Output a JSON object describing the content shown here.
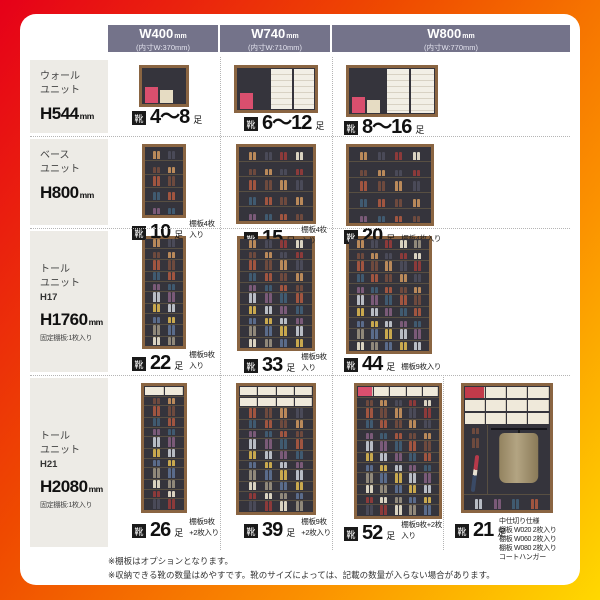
{
  "shoe_icon_glyph": "靴",
  "capacity_counter": "足",
  "colors": {
    "gradient": [
      "#e60019",
      "#ef4a00",
      "#ffd800"
    ],
    "header_bg": "#74738a",
    "row_label_bg": "#edebe6",
    "frame_wood": "#8a6542",
    "interior": "#35343c",
    "accent_box": "#d94f6e"
  },
  "header": {
    "columns": [
      {
        "title": "W400",
        "unit": "mm",
        "inner": "(内寸W:370mm)"
      },
      {
        "title": "W740",
        "unit": "mm",
        "inner": "(内寸W:710mm)"
      },
      {
        "title": "W800",
        "unit": "mm",
        "inner": "(内寸W:770mm)"
      }
    ]
  },
  "rows": [
    {
      "unit_lines": [
        "ウォール",
        "ユニット"
      ],
      "height": "H544",
      "height_unit": "mm",
      "cells": [
        {
          "count": "4〜8",
          "cabinet": {
            "kind": "wall",
            "w": 50,
            "h": 42,
            "boxes": [
              "#d94f6e",
              "#e6dcc3"
            ],
            "doors": 0
          }
        },
        {
          "count": "6〜12",
          "cabinet": {
            "kind": "wall",
            "w": 84,
            "h": 48,
            "boxes": [
              "#d94f6e"
            ],
            "doors": 2
          }
        },
        {
          "count": "8〜16",
          "cabinet": {
            "kind": "wall",
            "w": 92,
            "h": 52,
            "boxes": [
              "#d94f6e",
              "#e6dcc3"
            ],
            "doors": 2
          }
        }
      ]
    },
    {
      "unit_lines": [
        "ベース",
        "ユニット"
      ],
      "height": "H800",
      "height_unit": "mm",
      "cells": [
        {
          "count": "10",
          "note": "棚板4枚入り",
          "cabinet": {
            "kind": "shoes",
            "w": 44,
            "h": 74,
            "rows": 5,
            "cols": 2
          }
        },
        {
          "count": "15",
          "note": "棚板4枚入り",
          "cabinet": {
            "kind": "shoes",
            "w": 80,
            "h": 80,
            "rows": 5,
            "cols": 4
          }
        },
        {
          "count": "20",
          "note": "棚板4枚入り",
          "cabinet": {
            "kind": "shoes",
            "w": 88,
            "h": 82,
            "rows": 5,
            "cols": 4
          }
        }
      ]
    },
    {
      "unit_lines": [
        "トール",
        "ユニット"
      ],
      "code": "H17",
      "height": "H1760",
      "height_unit": "mm",
      "unit_note": "固定棚板:1枚入り",
      "cells": [
        {
          "count": "22",
          "note": "棚板9枚入り",
          "cabinet": {
            "kind": "shoes",
            "w": 44,
            "h": 113,
            "rows": 10,
            "cols": 2
          }
        },
        {
          "count": "33",
          "note": "棚板9枚入り",
          "cabinet": {
            "kind": "shoes",
            "w": 78,
            "h": 115,
            "rows": 10,
            "cols": 4
          }
        },
        {
          "count": "44",
          "note": "棚板9枚入り",
          "cabinet": {
            "kind": "shoes",
            "w": 86,
            "h": 118,
            "rows": 10,
            "cols": 5
          }
        }
      ]
    },
    {
      "unit_lines": [
        "トール",
        "ユニット"
      ],
      "code": "H21",
      "height": "H2080",
      "height_unit": "mm",
      "unit_note": "固定棚板:1枚入り",
      "cells": [
        {
          "count": "26",
          "note": "棚板9枚+2枚入り",
          "cabinet": {
            "kind": "shoes",
            "w": 46,
            "h": 130,
            "rows": 12,
            "cols": 2,
            "boxRows": 1
          }
        },
        {
          "count": "39",
          "note": "棚板9枚+2枚入り",
          "cabinet": {
            "kind": "shoes",
            "w": 80,
            "h": 132,
            "rows": 12,
            "cols": 4,
            "boxRows": 2
          }
        },
        {
          "count": "52",
          "note": "棚板9枚+2枚入り",
          "cabinet": {
            "kind": "shoes",
            "w": 88,
            "h": 136,
            "rows": 12,
            "cols": 5,
            "boxRows": 1,
            "pinkBox": true
          }
        },
        {
          "count": "21",
          "note_lines": [
            "中仕切り仕様",
            "棚板 W020 2枚入り",
            "棚板 W060 2枚入り",
            "棚板 W080 2枚入り",
            "コートハンガー"
          ],
          "cabinet": {
            "kind": "coat",
            "w": 92,
            "h": 130
          }
        }
      ]
    }
  ],
  "footnotes": [
    "※棚板はオプションとなります。",
    "※収納できる靴の数量はめやすです。靴のサイズによっては、記載の数量が入らない場合があります。"
  ]
}
